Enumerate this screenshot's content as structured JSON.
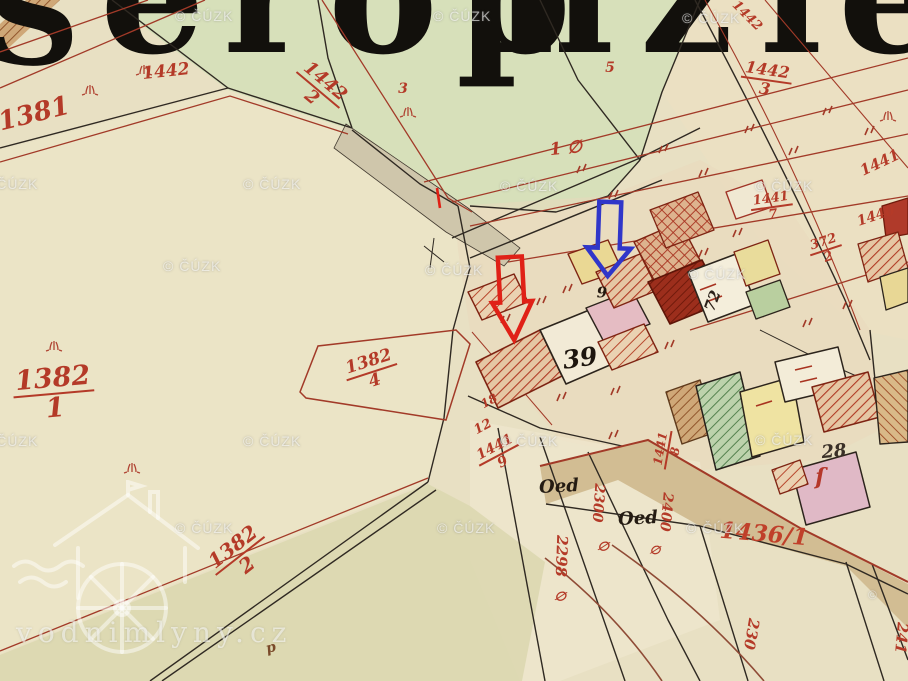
{
  "map": {
    "description_colors": {
      "parchment": "#e8e0c3",
      "green_field": "#d7e0ba",
      "road_tan": "#d2bd93",
      "boundary_black": "#2f2922",
      "survey_red": "#a23a28",
      "label_red": "#b43a28"
    }
  },
  "title": {
    "fragments": [
      {
        "text": "S",
        "x": -14,
        "baseline": 64,
        "size": 130,
        "ls": 0
      },
      {
        "text": "eröp",
        "x": 100,
        "baseline": 52,
        "size": 165,
        "ls": 18
      },
      {
        "text": "nzi",
        "x": 494,
        "baseline": 52,
        "size": 165,
        "ls": 26
      },
      {
        "text": "e",
        "x": 838,
        "baseline": 52,
        "size": 165,
        "ls": 0
      }
    ]
  },
  "watermarks": {
    "cuzk": "© ČÚZK",
    "site": "vodnimlyny.cz",
    "partial_copyright": "©",
    "partial_pos": {
      "x": 868,
      "y": 588
    },
    "positions": [
      [
        175,
        8
      ],
      [
        433,
        8
      ],
      [
        682,
        10
      ],
      [
        -20,
        176
      ],
      [
        243,
        176
      ],
      [
        500,
        178
      ],
      [
        755,
        178
      ],
      [
        163,
        258
      ],
      [
        425,
        262
      ],
      [
        688,
        266
      ],
      [
        -20,
        433
      ],
      [
        243,
        433
      ],
      [
        500,
        433
      ],
      [
        755,
        432
      ],
      [
        175,
        520
      ],
      [
        437,
        520
      ],
      [
        686,
        520
      ]
    ]
  },
  "annotations": {
    "red_arrow": {
      "color": "#e02117",
      "cx": 512,
      "shaft_w": 12,
      "head_w": 20,
      "top": 257,
      "shaft_bottom": 302,
      "tip_y": 340,
      "rot": -3,
      "stroke_w": 4.5
    },
    "blue_arrow": {
      "color": "#3036c9",
      "cx": 609,
      "shaft_w": 11,
      "head_w": 22,
      "top": 202,
      "shaft_bottom": 248,
      "tip_y": 276,
      "rot": 2,
      "stroke_w": 4.5
    }
  },
  "labels": [
    {
      "t": "1381",
      "x": 34,
      "y": 114,
      "rot": -14,
      "s": 26
    },
    {
      "t": "1442",
      "x": 166,
      "y": 72,
      "rot": -6,
      "s": 17
    },
    {
      "t": "1442",
      "den": "2",
      "x": 318,
      "y": 90,
      "rot": 40,
      "s": 18
    },
    {
      "t": "1442",
      "den": "3",
      "x": 766,
      "y": 80,
      "rot": 8,
      "s": 16
    },
    {
      "t": "3",
      "x": 403,
      "y": 89,
      "rot": 0,
      "s": 14
    },
    {
      "t": "5",
      "x": 610,
      "y": 68,
      "rot": 0,
      "s": 14
    },
    {
      "t": "1 ∅",
      "x": 566,
      "y": 149,
      "rot": -6,
      "s": 17
    },
    {
      "t": "1442",
      "x": 747,
      "y": 16,
      "rot": 45,
      "s": 13
    },
    {
      "t": "1441",
      "x": 880,
      "y": 163,
      "rot": -25,
      "s": 15
    },
    {
      "t": "1441",
      "den": "7",
      "x": 772,
      "y": 207,
      "rot": -8,
      "s": 13
    },
    {
      "t": "1440",
      "x": 876,
      "y": 216,
      "rot": -18,
      "s": 14
    },
    {
      "t": "372",
      "den": "2",
      "x": 826,
      "y": 250,
      "rot": -18,
      "s": 13
    },
    {
      "t": "1382",
      "den": "1",
      "x": 54,
      "y": 394,
      "rot": -5,
      "s": 27
    },
    {
      "t": "1382",
      "den": "4",
      "x": 372,
      "y": 372,
      "rot": -18,
      "s": 17
    },
    {
      "t": "1382",
      "den": "2",
      "x": 240,
      "y": 556,
      "rot": -38,
      "s": 20
    },
    {
      "t": "1436/1",
      "x": 764,
      "y": 534,
      "rot": 5,
      "s": 23,
      "c": "#c0402a"
    },
    {
      "t": "39",
      "x": 580,
      "y": 358,
      "rot": -8,
      "s": 25,
      "c": "#1d150e"
    },
    {
      "t": "9",
      "x": 602,
      "y": 293,
      "rot": 0,
      "s": 15,
      "c": "#241a10"
    },
    {
      "t": "72",
      "x": 713,
      "y": 301,
      "rot": -70,
      "s": 15,
      "c": "#2a2018"
    },
    {
      "t": "28",
      "x": 834,
      "y": 452,
      "rot": -5,
      "s": 18,
      "c": "#3a3028"
    },
    {
      "t": "Oed",
      "x": 559,
      "y": 487,
      "rot": -3,
      "s": 18,
      "c": "#241b12"
    },
    {
      "t": "Oed",
      "x": 638,
      "y": 519,
      "rot": -3,
      "s": 18,
      "c": "#241b12"
    },
    {
      "t": "2298",
      "x": 561,
      "y": 556,
      "rot": 92,
      "s": 15
    },
    {
      "t": "∅",
      "x": 560,
      "y": 597,
      "rot": 10,
      "s": 13
    },
    {
      "t": "2300",
      "x": 598,
      "y": 503,
      "rot": 94,
      "s": 14
    },
    {
      "t": "∅",
      "x": 603,
      "y": 547,
      "rot": 10,
      "s": 13
    },
    {
      "t": "2400",
      "x": 666,
      "y": 512,
      "rot": 95,
      "s": 14
    },
    {
      "t": "∅",
      "x": 655,
      "y": 550,
      "rot": 10,
      "s": 12
    },
    {
      "t": "230",
      "x": 751,
      "y": 634,
      "rot": 100,
      "s": 15
    },
    {
      "t": "241",
      "x": 901,
      "y": 638,
      "rot": 95,
      "s": 15
    },
    {
      "t": "12",
      "x": 483,
      "y": 427,
      "rot": -28,
      "s": 13
    },
    {
      "t": "18",
      "x": 489,
      "y": 401,
      "rot": -28,
      "s": 12
    },
    {
      "t": "1441",
      "den": "9",
      "x": 499,
      "y": 455,
      "rot": -28,
      "s": 14
    },
    {
      "t": "1441",
      "den": "8",
      "x": 668,
      "y": 450,
      "rot": -80,
      "s": 12
    },
    {
      "t": "ſ",
      "x": 820,
      "y": 477,
      "rot": 0,
      "s": 22,
      "c": "#b5372a"
    },
    {
      "t": "p",
      "x": 271,
      "y": 648,
      "rot": -15,
      "s": 14,
      "c": "#7a4a2a"
    }
  ]
}
